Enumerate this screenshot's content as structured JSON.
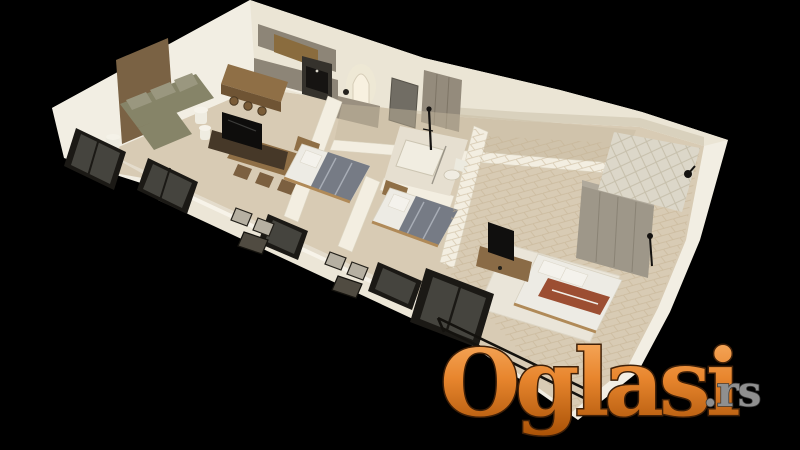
{
  "scene": {
    "type": "3d-apartment-floor-plan-render",
    "background": "#000000",
    "rooms": [
      "living-room",
      "kitchen",
      "dining-area",
      "hallway",
      "bedroom-1",
      "bedroom-2",
      "bathroom",
      "master-bedroom",
      "master-bathroom",
      "terrace-balcony",
      "master-balcony"
    ]
  },
  "watermark": {
    "brand": "Oglasi",
    "suffix": ".rs",
    "gradient_top": "#f9b168",
    "gradient_mid": "#e8862e",
    "gradient_bottom": "#a85106",
    "outline_color": "#3f2008",
    "suffix_color": "#8f8f8f"
  },
  "palette": {
    "bg": "#000000",
    "wall_face": "#f2eee3",
    "wall_face2": "#ebe5d5",
    "wall_top": "#f3eee1",
    "wall_shade": "#ddd5c2",
    "floor_main": "#d8cbb4",
    "floor_balcony": "#e6dfd0",
    "floor_bath": "#e6dfd0",
    "floor_tile": "#dcd7c9",
    "corridor": "#c8ba9f",
    "rug": "#eae5d9",
    "accent_panel": "#7a6244",
    "wood": "#8f6f46",
    "wood_dark": "#463828",
    "cabinet_gray": "#8d8577",
    "cabinet_wood": "#8a6c3e",
    "sofa": "#868468",
    "sofa_light": "#9a977f",
    "bed_frame": "#b08a58",
    "blanket": "#767b85",
    "linen": "#edebe4",
    "rust": "#9c4e32",
    "frame_black": "#1b1915",
    "glass": "#45443e",
    "headboard": "#9e9789",
    "door_gray": "#716d64"
  }
}
